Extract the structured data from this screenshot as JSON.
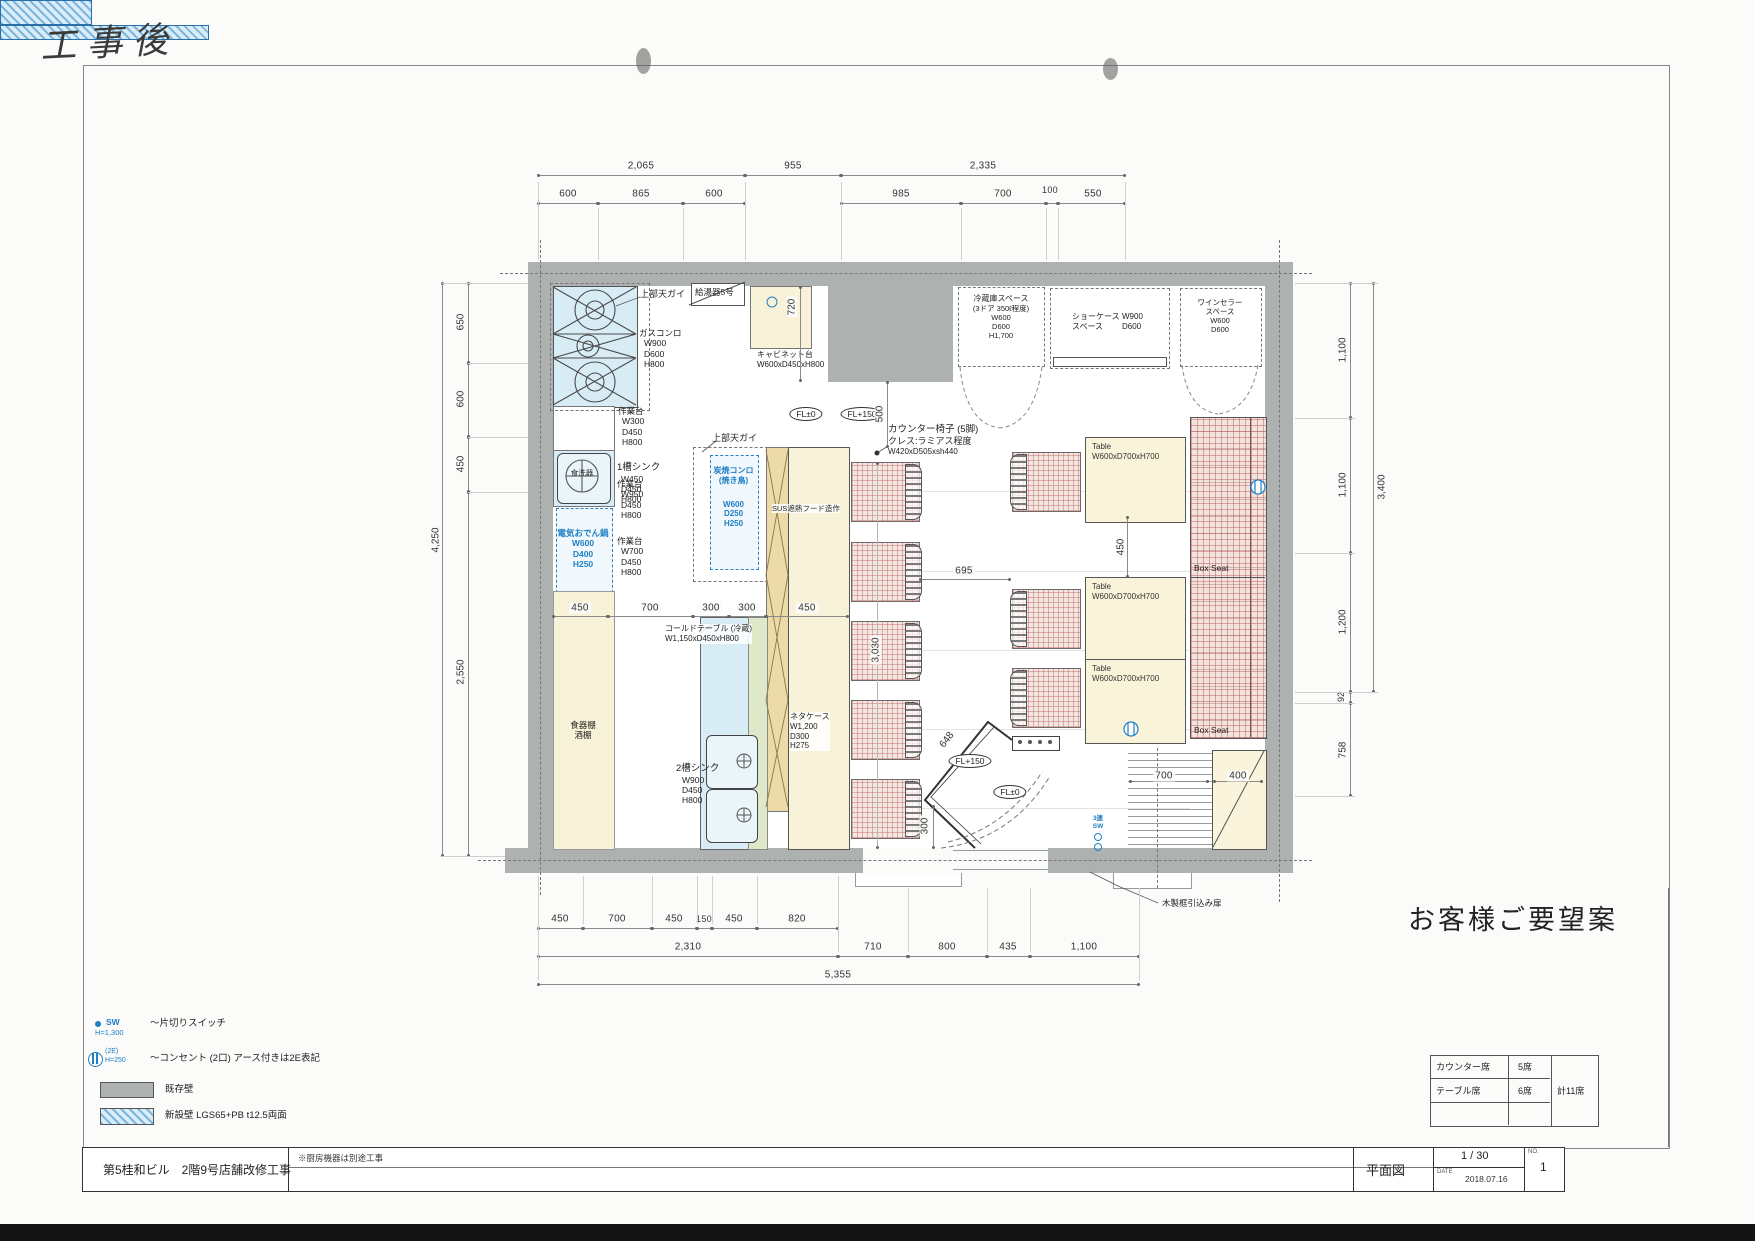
{
  "note": "工事後",
  "dims": {
    "top_a": [
      "2,065",
      "955",
      "2,335"
    ],
    "top_b": [
      "600",
      "865",
      "600",
      "985",
      "700",
      "100",
      "550"
    ],
    "left_total": "4,250",
    "left": [
      "650",
      "600",
      "450",
      "2,550"
    ],
    "right": [
      "1,100",
      "1,100",
      "1,200",
      "92",
      "758"
    ],
    "right_total": "3,400",
    "bot_a": [
      "450",
      "700",
      "450",
      "150",
      "450",
      "820"
    ],
    "bot_b": [
      "2,310",
      "710",
      "800",
      "435",
      "1,100"
    ],
    "bot_total": "5,355",
    "inner": [
      "450",
      "700",
      "300",
      "300",
      "450"
    ],
    "v720": "720",
    "v500": "500",
    "v3030": "3,030",
    "h695": "695",
    "t450": "450",
    "d648": "648",
    "v300": "300",
    "s700": "700",
    "s400": "400"
  },
  "levels": {
    "fl0": "FL±0",
    "fl150": "FL+150"
  },
  "kitchen": {
    "hood1": "上部天ガイ",
    "boiler": "給湯器5号",
    "stove": {
      "name": "ガスコンロ",
      "w": "W900",
      "d": "D600",
      "h": "H800"
    },
    "worktop1": {
      "name": "作業台",
      "w": "W300",
      "d": "D450",
      "h": "H800"
    },
    "sink1": {
      "name": "1槽シンク",
      "w": "W450",
      "d": "D450",
      "h": "H800"
    },
    "dishwasher": "食洗器",
    "oden": {
      "name": "電気おでん鍋",
      "w": "W600",
      "d": "D400",
      "h": "H250"
    },
    "worktop2": {
      "name": "作業台",
      "w": "W950",
      "d": "D450",
      "h": "H800"
    },
    "worktop3": {
      "name": "作業台",
      "w": "W700",
      "d": "D450",
      "h": "H800"
    },
    "hood2": "上部天ガイ",
    "grill": {
      "name": "炭焼コンロ",
      "sub": "(焼き鳥)",
      "w": "W600",
      "d": "D250",
      "h": "H250"
    },
    "sus": "SUS遮熱フード造作",
    "cabinet": {
      "name": "キャビネット台",
      "size": "W600xD450xH800"
    },
    "coldtable": {
      "name": "コールドテーブル (冷蔵)",
      "size": "W1,150xD450xH800"
    },
    "sink2": {
      "name": "2槽シンク",
      "w": "W900",
      "d": "D450",
      "h": "H800"
    },
    "netacase": {
      "name": "ネタケース",
      "w": "W1,200",
      "d": "D300",
      "h": "H275"
    },
    "cupboard1": "食器棚",
    "cupboard2": "酒棚"
  },
  "appliances": {
    "fridge": {
      "l1": "冷蔵庫スペース",
      "l2": "(3ドア 350ℓ程度)",
      "w": "W600",
      "d": "D600",
      "h": "H1,700"
    },
    "showcase": {
      "l1": "ショーケース",
      "l2": "スペース",
      "w": "W900",
      "d": "D600"
    },
    "wine": {
      "l1": "ワインセラー",
      "l2": "スペース",
      "w": "W600",
      "d": "D600"
    }
  },
  "dining": {
    "counter_chairs": {
      "l1": "カウンター椅子 (5脚)",
      "l2": "クレス:ラミアス程度",
      "l3": "W420xD505xsh440"
    },
    "table_label": "Table",
    "table_size": "W600xD700xH700",
    "box_seat": "Box Seat"
  },
  "entrance": {
    "door": "木製框引込み扉",
    "sw3": "3連",
    "sw": "SW"
  },
  "legend": {
    "sw": {
      "sym": "SW",
      "h": "H=1,300",
      "label": "〜片切りスイッチ"
    },
    "outlet": {
      "sym": "(2E)",
      "h": "H=250",
      "label": "〜コンセント (2口) アース付きは2E表記"
    },
    "wall_exist": "既存壁",
    "wall_new": "新設壁  LGS65+PB t12.5両面"
  },
  "proposal": {
    "title": "お客様ご要望案",
    "r1c1": "カウンター席",
    "r1c2": "5席",
    "r2c1": "テーブル席",
    "r2c2": "6席",
    "total": "計11席"
  },
  "titleblock": {
    "project": "第5桂和ビル　2階9号店舗改修工事",
    "note": "※厨房機器は別途工事",
    "drawing": "平面図",
    "scale": "1 / 30",
    "date_label": "DATE",
    "date": "2018.07.16",
    "no_label": "NO.",
    "no": "1"
  }
}
